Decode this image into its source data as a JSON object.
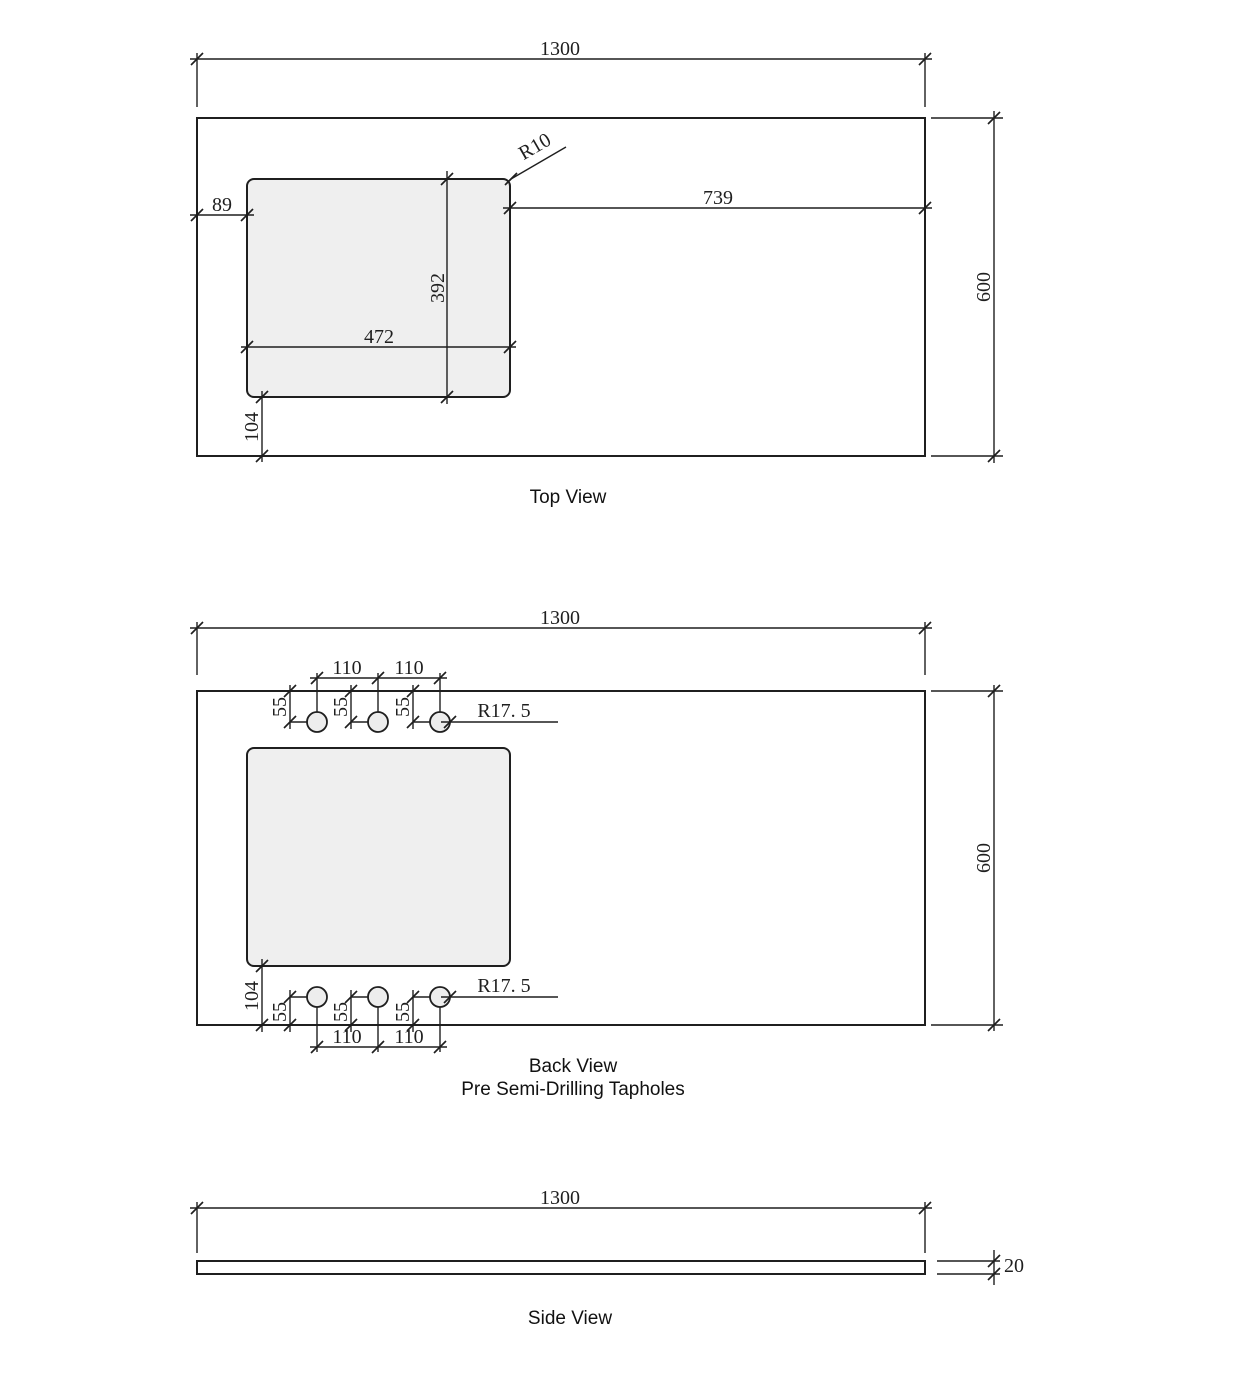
{
  "drawing": {
    "type": "technical-drawing",
    "subject": "benchtop with sink cutout and tapholes",
    "colors": {
      "line": "#1f1f1f",
      "cutout_fill": "#efefef",
      "background": "#ffffff"
    }
  },
  "top_view": {
    "label": "Top View",
    "overall_width": "1300",
    "overall_depth": "600",
    "cutout_left_offset": "89",
    "cutout_right_offset": "739",
    "cutout_width": "472",
    "cutout_depth": "392",
    "cutout_bottom_offset": "104",
    "corner_radius": "R10"
  },
  "back_view": {
    "label": "Back View",
    "sublabel": "Pre Semi-Drilling Tapholes",
    "overall_width": "1300",
    "overall_depth": "600",
    "taphole_spacing": "110",
    "taphole_edge_offset": "55",
    "taphole_radius": "R17. 5",
    "cutout_bottom_offset": "104"
  },
  "side_view": {
    "label": "Side View",
    "overall_width": "1300",
    "thickness": "20"
  }
}
